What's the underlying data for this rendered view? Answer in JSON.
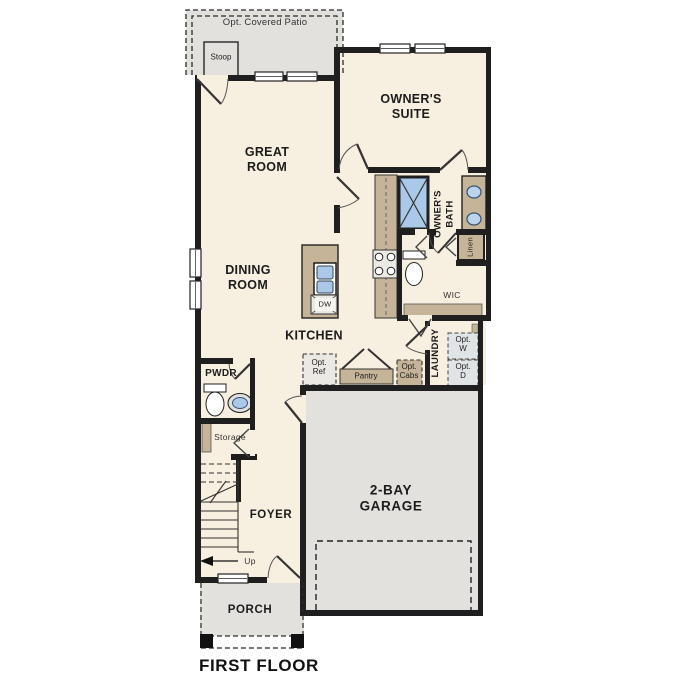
{
  "plan_title": "FIRST FLOOR",
  "colors": {
    "wall": "#1f1f1f",
    "floor": "#f7efdf",
    "outdoor": "#e2e1de",
    "cabinet": "#c5b498",
    "fixture_blue": "#aac9e8",
    "appliance": "#eae9e4"
  },
  "rooms": {
    "great_room": "GREAT\nROOM",
    "owners_suite": "OWNER'S\nSUITE",
    "dining_room": "DINING\nROOM",
    "kitchen": "KITCHEN",
    "owners_bath": "OWNER'S\nBATH",
    "wic": "WIC",
    "laundry": "LAUNDRY",
    "pwdr": "PWDR",
    "foyer": "FOYER",
    "storage": "Storage",
    "linen": "Linen",
    "garage": "2-BAY\nGARAGE",
    "porch": "PORCH",
    "patio": "Opt. Covered Patio",
    "stoop": "Stoop"
  },
  "annotations": {
    "dw": "DW",
    "opt_w": "Opt.\nW",
    "opt_d": "Opt.\nD",
    "opt_ref": "Opt.\nRef",
    "pantry": "Pantry",
    "opt_cabs": "Opt.\nCabs",
    "up": "Up"
  }
}
